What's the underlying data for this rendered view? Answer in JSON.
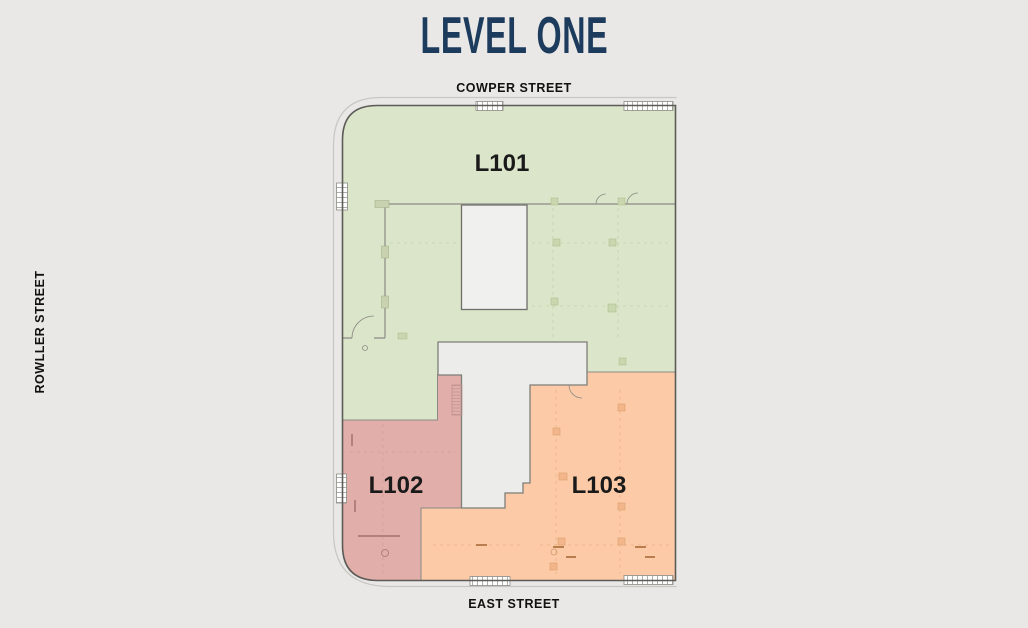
{
  "page": {
    "title": "LEVEL ONE",
    "title_color": "#1d3b5d",
    "background": "#e9e8e6"
  },
  "streets": {
    "top": "COWPER STREET",
    "left": "ROWLLER STREET",
    "bottom": "EAST STREET"
  },
  "floor_plan": {
    "label_color": "#1a1a1a",
    "units": [
      {
        "id": "L101",
        "label": "L101",
        "color": "#dbe5c9",
        "border": "#9fae85"
      },
      {
        "id": "L102",
        "label": "L102",
        "color": "#e2aeaa",
        "border": "#bb8f8b"
      },
      {
        "id": "L103",
        "label": "L103",
        "color": "#fccaa6",
        "border": "#d09a6e"
      }
    ]
  }
}
